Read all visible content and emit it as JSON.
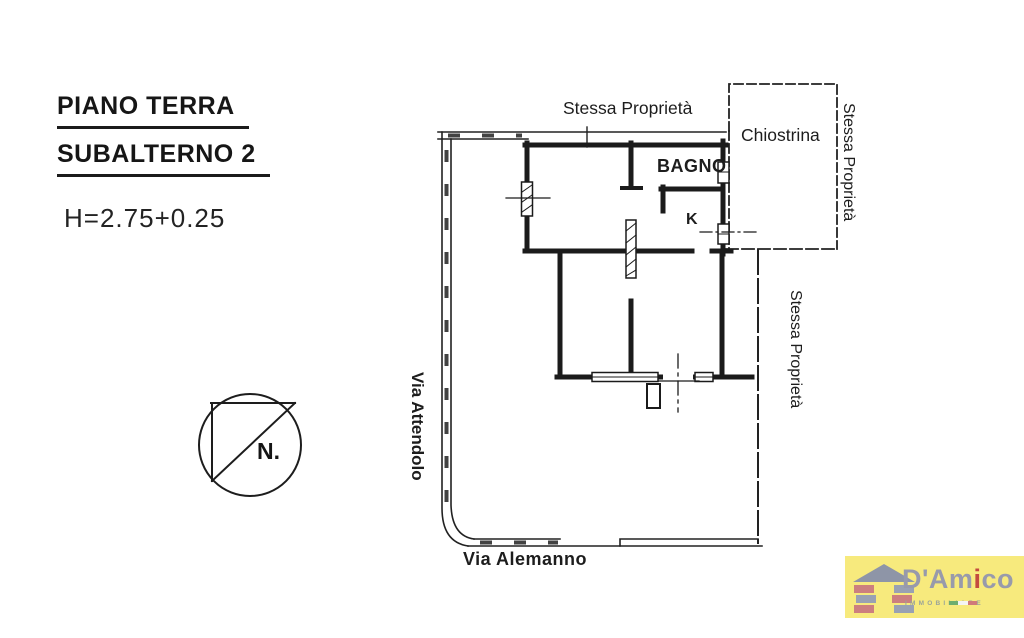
{
  "page": {
    "background": "#ffffff",
    "ink": "#222222"
  },
  "title_block": {
    "line1": "PIANO TERRA",
    "line2": "SUBALTERNO 2",
    "height_note": "H=2.75+0.25"
  },
  "plan": {
    "labels": {
      "adjacent_property_top": "Stessa Proprietà",
      "courtyard": "Chiostrina",
      "bathroom": "BAGNO",
      "kitchen": "K",
      "adjacent_property_right_upper": "Stessa Proprietà",
      "adjacent_property_right_lower": "Stessa Proprietà",
      "street_left": "Via Attendolo",
      "street_bottom": "Via Alemanno"
    },
    "compass": {
      "label": "N."
    }
  },
  "logo": {
    "name_prefix": "D'Am",
    "name_accent": "i",
    "name_suffix": "co",
    "subtitle": "IMMOBILIARE",
    "colors": {
      "background": "#f7ea7d",
      "text": "#989aab",
      "accent": "#c34a3f",
      "roof": "#8e95a7",
      "brick_red": "#cc7f7f",
      "brick_gray": "#99a1b3"
    }
  }
}
